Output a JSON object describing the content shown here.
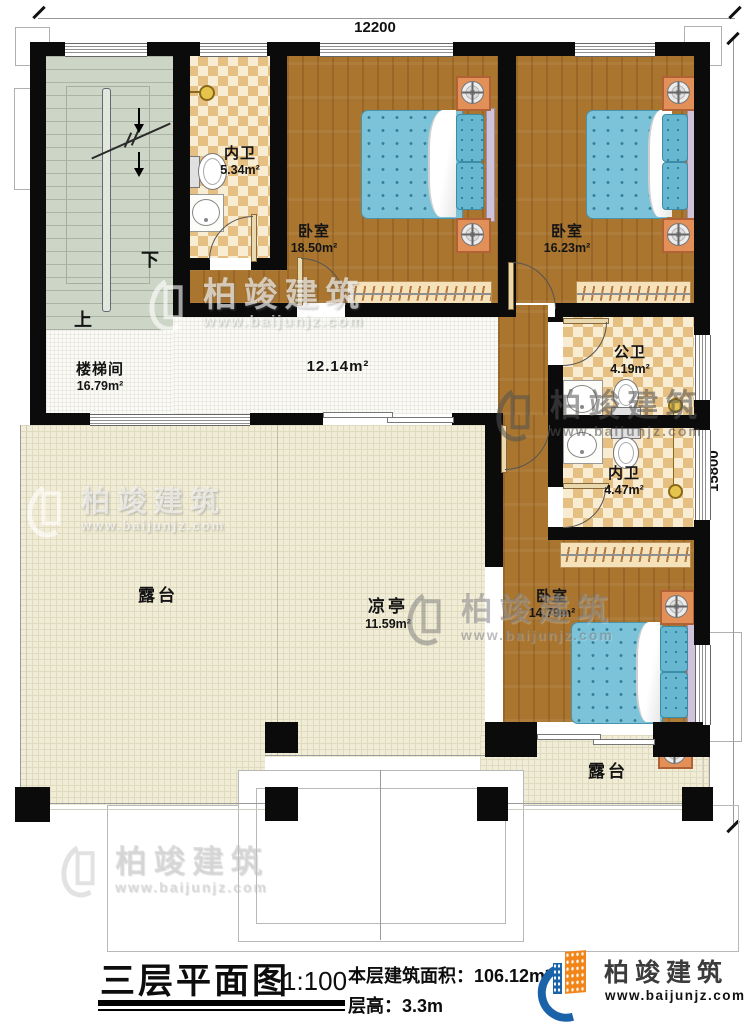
{
  "dimensions": {
    "width_top": "12200",
    "height_right": "15800"
  },
  "rooms": {
    "stairwell": {
      "name": "楼梯间",
      "area": "16.79m²"
    },
    "bath_top": {
      "name": "内卫",
      "area": "5.34m²"
    },
    "bedroom1": {
      "name": "卧室",
      "area": "18.50m²"
    },
    "bedroom2": {
      "name": "卧室",
      "area": "16.23m²"
    },
    "corridor": {
      "area": "12.14m²"
    },
    "public_bath": {
      "name": "公卫",
      "area": "4.19m²"
    },
    "inner_bath": {
      "name": "内卫",
      "area": "4.47m²"
    },
    "bedroom3": {
      "name": "卧室",
      "area": "14.79m²"
    },
    "terrace_left": {
      "name": "露台"
    },
    "pavilion": {
      "name": "凉亭",
      "area": "11.59m²"
    },
    "terrace_right": {
      "name": "露台"
    }
  },
  "stairs": {
    "up_label": "上",
    "down_label": "下"
  },
  "footer": {
    "title": "三层平面图",
    "scale": "1:100",
    "area_label": "本层建筑面积：",
    "area_value": "106.12m²",
    "height_label": "层高：",
    "height_value": "3.3m"
  },
  "brand": {
    "name": "柏竣建筑",
    "url": "www.baijunjz.com"
  },
  "watermark": {
    "name": "柏竣建筑",
    "url": "www.baijunjz.com"
  },
  "colors": {
    "wall": "#0b0b0b",
    "wood": "#a9752f",
    "tile_dark": "#e6bf82",
    "tile_light": "#f8ecd2",
    "stair_green": "#ccd5c6",
    "terrace": "#f1ecd6",
    "bed_blue": "#7cc3d9",
    "brand_blue": "#1a63a8",
    "brand_orange": "#f28519"
  }
}
